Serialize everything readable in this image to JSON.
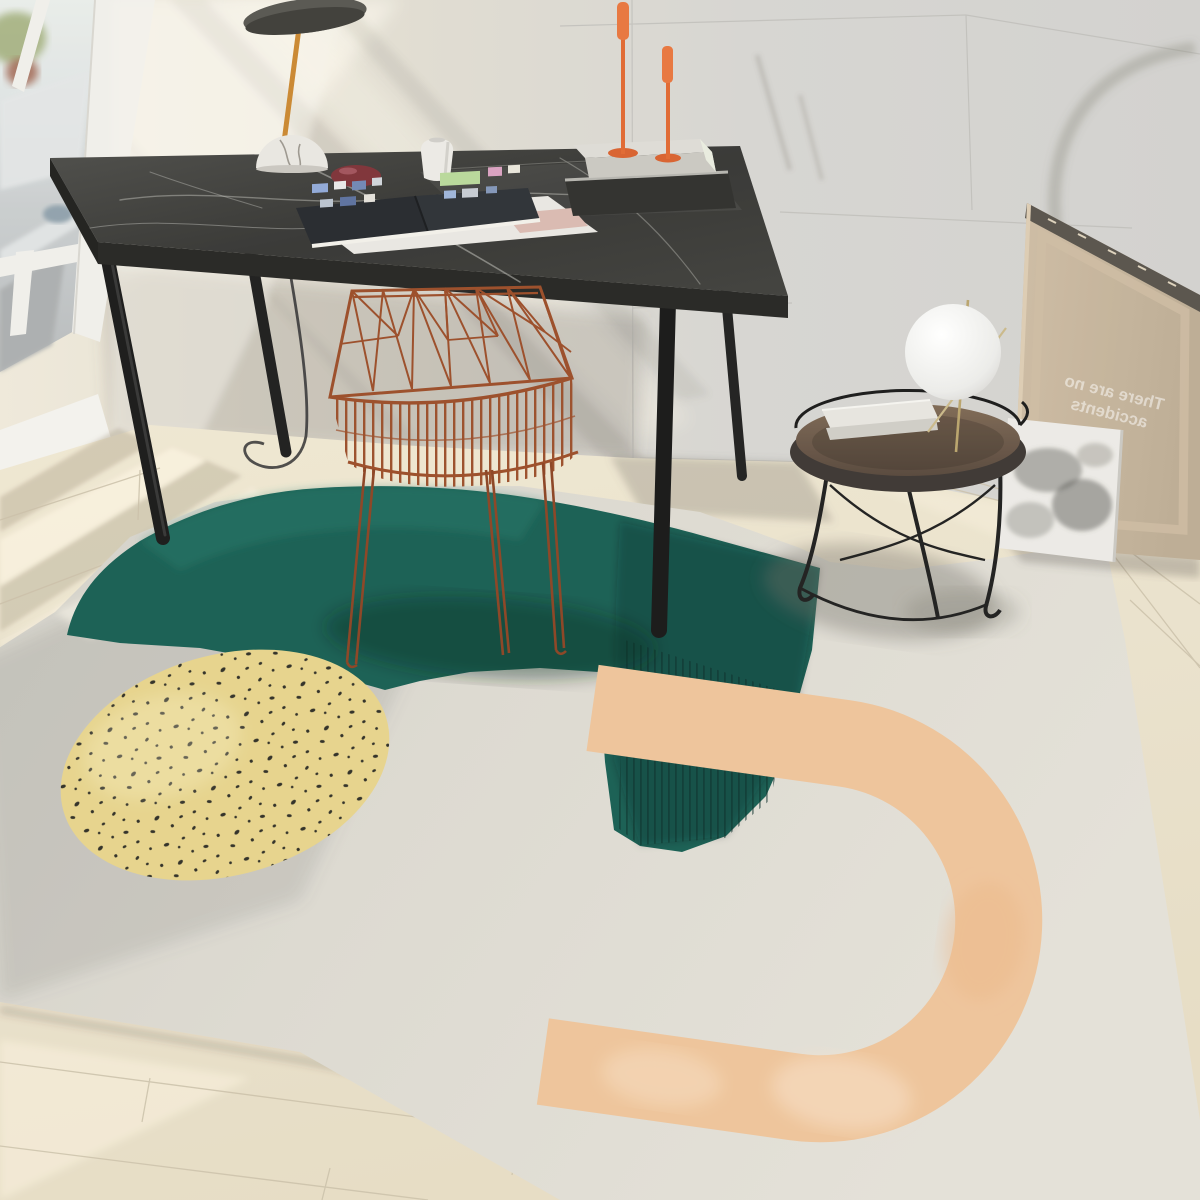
{
  "meta": {
    "domain": "natural-image",
    "description": "Product photograph of a modern abstract area rug styled in a sunlit room with a black marble desk, rust wire chair, round side table with globe lamp, and a reversed canvas leaning on the wall",
    "dimensions": "1200x1200"
  },
  "scene": {
    "objects": [
      {
        "name": "window",
        "desc": "white framed window with blurred street view and sheer curtain"
      },
      {
        "name": "desk",
        "desc": "black marble top desk with cylindrical black metal legs"
      },
      {
        "name": "desk-lamp",
        "desc": "disc shade lamp with brass stem and white marble dome base"
      },
      {
        "name": "magazine",
        "desc": "open magazine lying on loose magazines"
      },
      {
        "name": "book-stack",
        "desc": "two stacked books holding two orange candlesticks"
      },
      {
        "name": "pebble",
        "desc": "dark red decorative stone"
      },
      {
        "name": "vase",
        "desc": "small white faceted vase"
      },
      {
        "name": "wire-chair",
        "desc": "rust orange geometric wire chair with hairpin legs"
      },
      {
        "name": "side-table",
        "desc": "round wood tray side table with black wire frame"
      },
      {
        "name": "sphere-lamp",
        "desc": "white globe table lamp with thin rods"
      },
      {
        "name": "leaning-canvas",
        "desc": "back of a stretched canvas leaning against the wall"
      },
      {
        "name": "art-print",
        "desc": "small grey ink-wash print leaning in front of the canvas"
      },
      {
        "name": "rug",
        "desc": "large beige area rug with abstract teal, yellow and orange shapes"
      }
    ],
    "canvas": {
      "text_line1": "There are no",
      "text_line2": "accidents",
      "note": "text appears mirrored on the canvas back"
    },
    "rug_shapes": [
      {
        "name": "teal-blob",
        "color": "#145c51"
      },
      {
        "name": "yellow-dotted-circle",
        "color": "#e6d38b",
        "dot_color": "#2d2c24"
      },
      {
        "name": "orange-u-shape",
        "color": "#eec39a"
      }
    ],
    "palette": {
      "wall": "#d5d4d2",
      "wall_sunlit": "#eae5d8",
      "floor": "#eae1cc",
      "rug": "#dcd9d1",
      "desk_marble": "#3a3a38",
      "chair": "#9a4a26",
      "candles": "#e8743c",
      "teal": "#145c51",
      "teal_dark": "#0c4640",
      "yellow": "#e6d38b",
      "orange_u": "#eec39a",
      "canvas_back": "#c2b096",
      "table_wood": "#6e5948"
    }
  }
}
